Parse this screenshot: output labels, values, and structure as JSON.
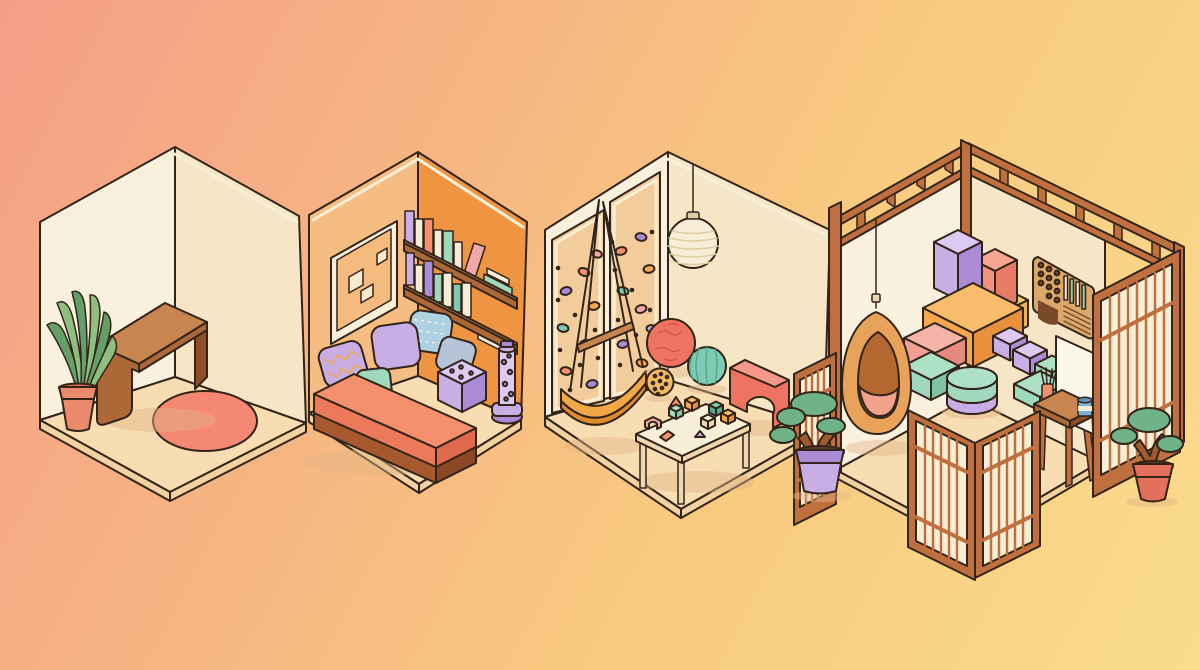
{
  "scene": {
    "description": "Isometric illustration of four cozy rooms on a warm pink-to-yellow gradient background",
    "rooms": [
      {
        "id": "minimal-room",
        "label": "Minimal room",
        "objects": [
          "potted snake plant",
          "wooden arch bench",
          "round coral rug"
        ]
      },
      {
        "id": "reading-nook",
        "label": "Reading nook",
        "objects": [
          "framed abstract art",
          "two wall bookshelves with books",
          "daybed with five pillows",
          "tufted lavender pouf",
          "bubble tube floor lamp"
        ]
      },
      {
        "id": "play-room",
        "label": "Play room",
        "objects": [
          "rock climbing wall with holds",
          "paper lantern pendant",
          "rope swing with wooden bar",
          "coral exercise ball",
          "teal exercise ball",
          "dotted yellow ball",
          "coral arch balance toy",
          "activity table with building blocks"
        ]
      },
      {
        "id": "zen-studio",
        "label": "Zen studio",
        "objects": [
          "timber post-and-beam frame",
          "hanging egg chair",
          "stacked foam play blocks",
          "cylinder pouf",
          "wooden sensory wall panel",
          "easel with brushes and paint jar",
          "folding shoji screens",
          "two bonsai trees in pots"
        ]
      }
    ]
  },
  "colors": {
    "outline": "#33241a",
    "bg1": "#f59e87",
    "bg2": "#f6b383",
    "bg3": "#f8ca80",
    "bg4": "#f9dc8e",
    "cream": "#f8efd8",
    "cream_dark": "#eed7ae",
    "wall_cream": "#f9f1de",
    "wall_cream2": "#f6e6c6",
    "wall_peach": "#f6bd83",
    "wall_orange": "#ef9440",
    "art_bg": "#f4ba7e",
    "art_square": "#f9e9cc",
    "floor": "#f8dcb2",
    "floor_side": "#f3d2a2",
    "shadow": "#e3b586",
    "wood_top": "#c9854f",
    "wood_mid": "#ad6838",
    "wood_dark": "#8d4e28",
    "wood_base": "#a8582e",
    "wood_deep": "#8d4626",
    "frame_wood": "#c0703e",
    "terracotta": "#ec8a6d",
    "terracotta_dark": "#d96f55",
    "coral": "#f4906e",
    "coral_dark": "#ec7a5a",
    "coral_deep": "#e06a4e",
    "coral_red": "#e8604f",
    "coral_light": "#f5998a",
    "rug": "#f58873",
    "leaf": "#8fbf7f",
    "leaf_dark": "#649e68",
    "bonsai_green": "#6fb287",
    "trunk": "#a05a2e",
    "soil": "#5d3d26",
    "lavender": "#c9aee6",
    "lavender_dark": "#ab8ad6",
    "lavender_light": "#ddcaf2",
    "purple_dot": "#9c7bc4",
    "mint": "#9fd8ba",
    "mint_dark": "#7fc3a4",
    "mint_light": "#aee0c6",
    "blue_gray": "#b6c4d8",
    "blue_pattern": "#aed1e4",
    "orange": "#f5a74e",
    "orange_dark": "#e8903a",
    "orange_top": "#f8bc6a",
    "seat_orange": "#f2a845",
    "seat_orange_dark": "#dd8b2b",
    "yellow": "#f6c96e",
    "yellow_dark": "#edb254",
    "salmon": "#f29180",
    "salmon_dark": "#e87b66",
    "salmon_light": "#f6a794",
    "pink": "#f2a094",
    "pink_light": "#f6b4a8",
    "pink_dark": "#e68a7e",
    "tan_panel": "#f2cd9b",
    "panel_tan": "#dba76a",
    "panel_dark": "#7a4a28",
    "slat_green": "#9fc9a4",
    "teal": "#7ecbb4",
    "teal_dark": "#58a88e",
    "coral_ball": "#ef7361",
    "coral_ball_dark": "#d95545",
    "yellow_ball": "#f3ba62",
    "yellow_ball_dot": "#e0913c",
    "lantern": "#f8eed8",
    "lantern_dark": "#e0cba4",
    "white_board": "#fbf6ea",
    "jar_blue": "#7db3d9",
    "jar_lid": "#5f92bd",
    "egg_body": "#e9a259",
    "egg_inner": "#b4682f",
    "cushion": "#f2a18c",
    "book_cream": "#f7ecd7",
    "hold_blue": "#a8c0e8",
    "hold_pink": "#f2a8a8",
    "pot_red": "#e2705a"
  }
}
